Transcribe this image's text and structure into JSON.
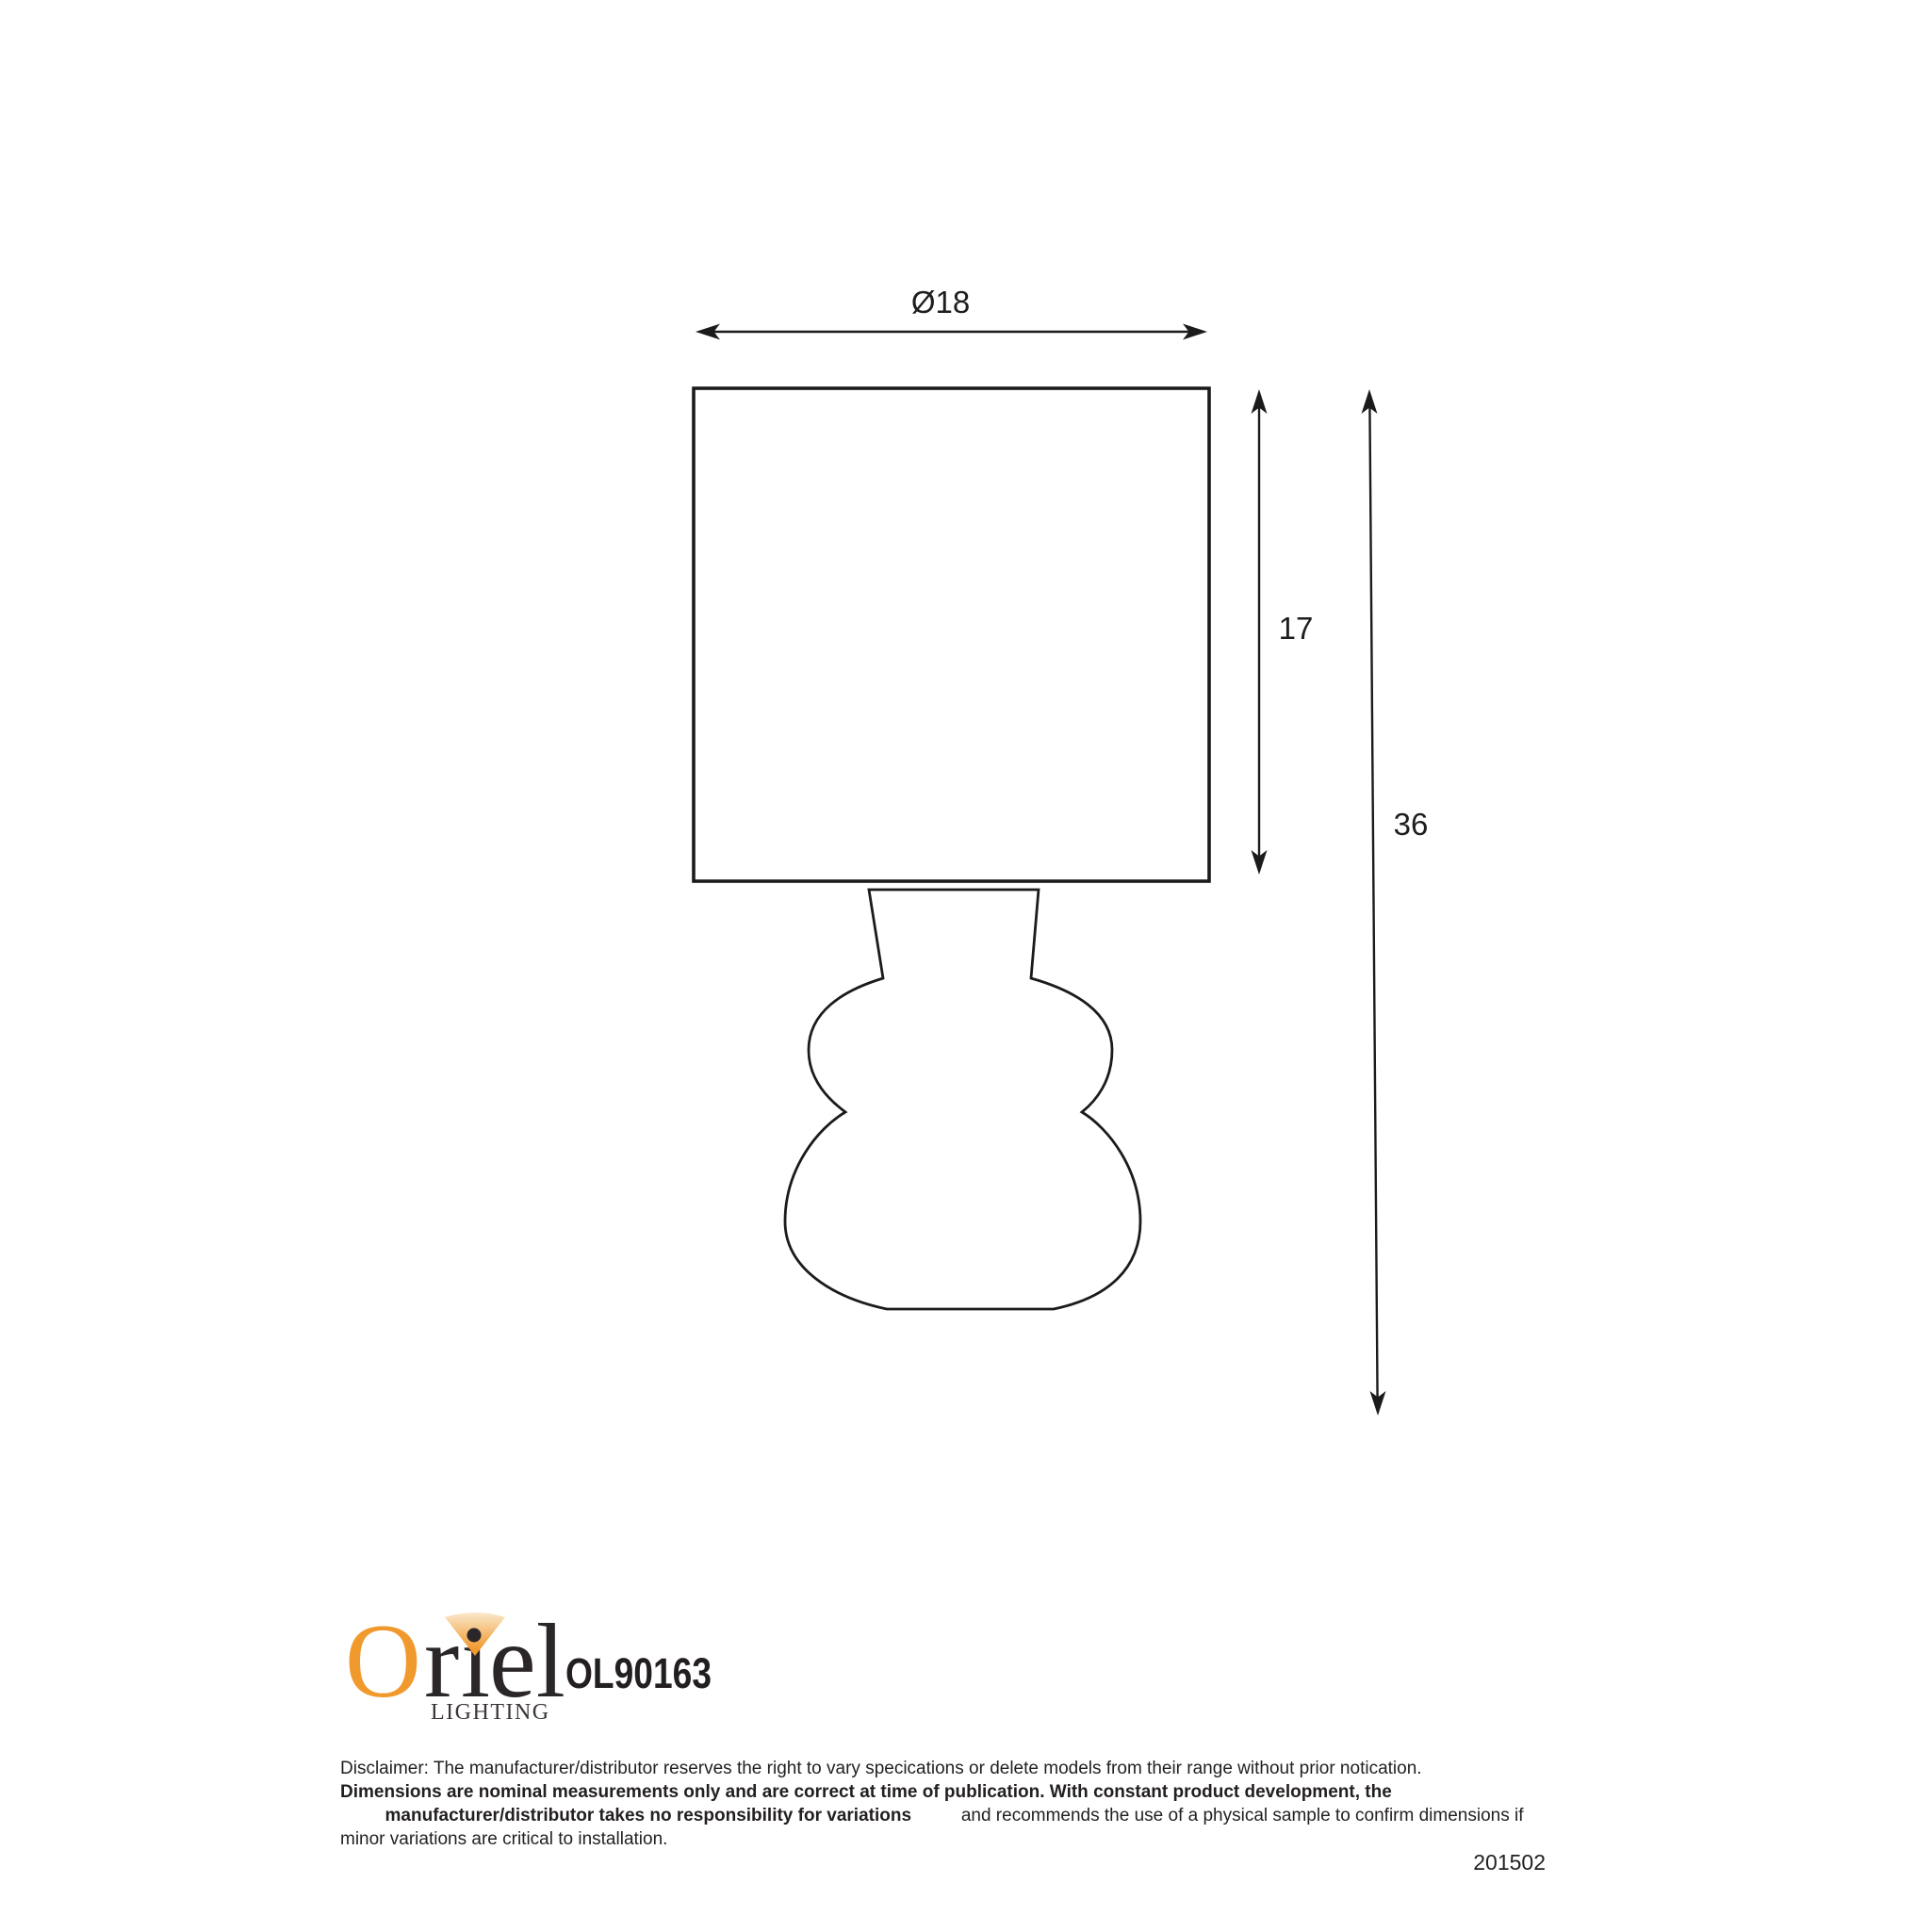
{
  "drawing": {
    "width_dim": "Ø18",
    "shade_height_dim": "17",
    "total_height_dim": "36"
  },
  "logo": {
    "name": "Oriel",
    "letter_o": "O",
    "letter_r": "r",
    "letter_i": "ı",
    "letters_el": "el",
    "subtitle": "LIGHTING",
    "orange": "#F0992D",
    "dark": "#2B2627"
  },
  "product": {
    "model": "OL90163"
  },
  "disclaimer": {
    "line1": "Disclaimer: The manufacturer/distributor reserves the right to vary specications or delete models from their range without prior notication.",
    "line2_bold": "Dimensions are nominal measurements only and are correct at time of publication. With constant product development, the",
    "line3_bold": "manufacturer/distributor takes no responsibility for variations",
    "line3_regular": " and recommends the use of a physical sample to confirm dimensions if",
    "line4": "minor variations are critical to installation."
  },
  "footer": {
    "code": "201502"
  }
}
